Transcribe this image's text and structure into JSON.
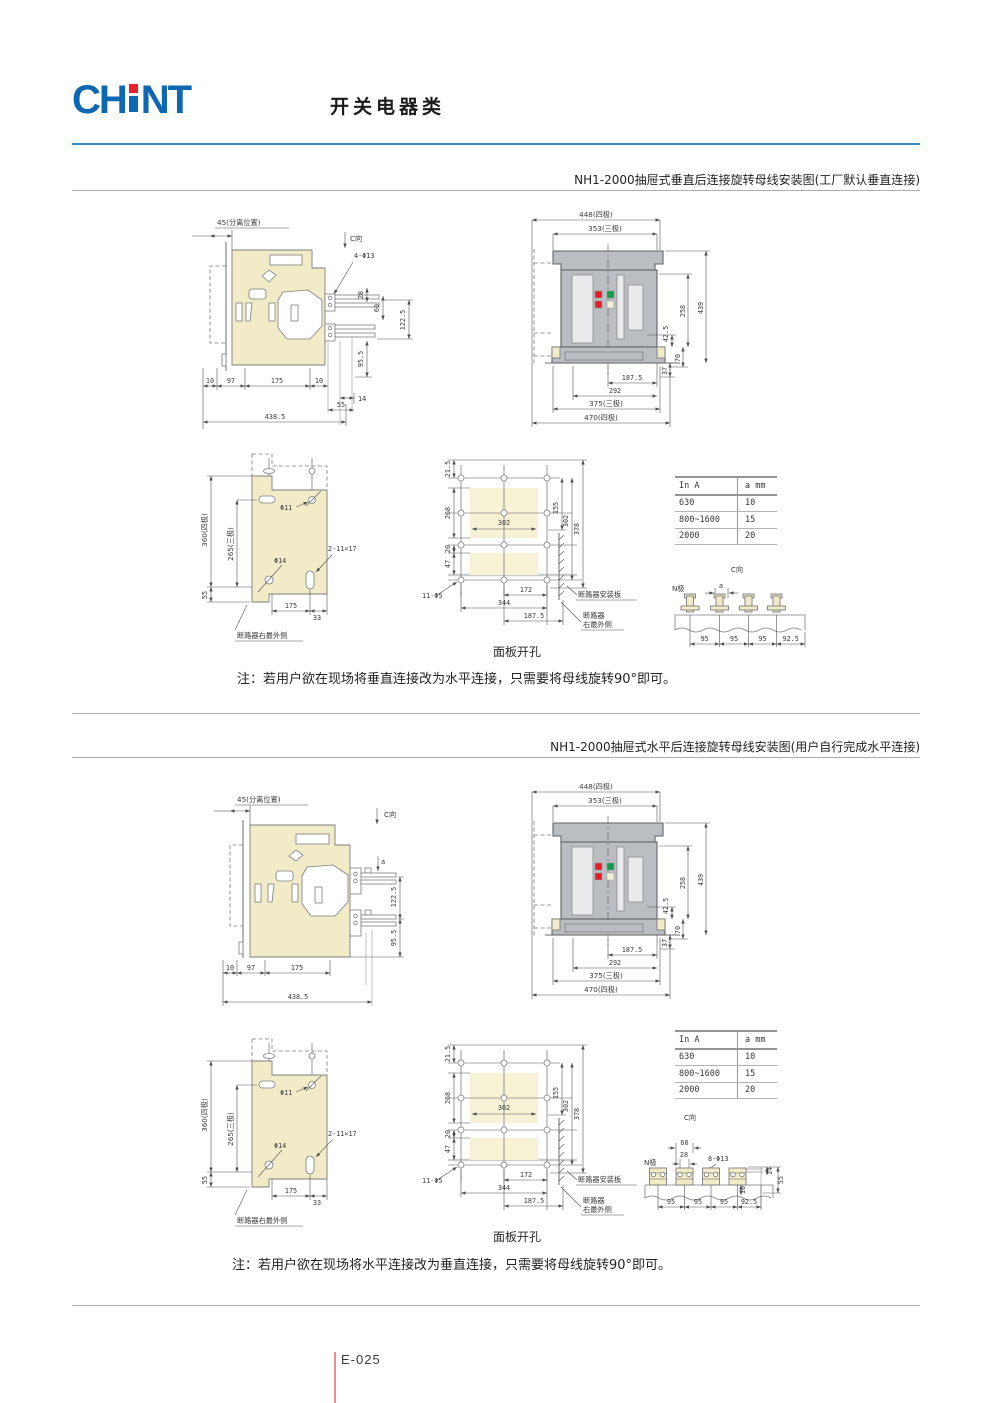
{
  "header": {
    "logo_ch": "CH",
    "logo_nt": "NT",
    "title": "开关电器类"
  },
  "footer": {
    "page_code": "E-025"
  },
  "colors": {
    "brand_blue": "#0d68b1",
    "rule_blue": "#3c86c6",
    "body_cream": "#f2ebc7",
    "housing_gray": "#babdc1",
    "indicator_red": "#e41e26",
    "indicator_green": "#149a48",
    "footer_line_red": "#ec8c8c"
  },
  "ref_table": {
    "col_current": "In A",
    "col_a": "a mm",
    "rows": [
      [
        "630",
        "10"
      ],
      [
        "800~1600",
        "15"
      ],
      [
        "2000",
        "20"
      ]
    ]
  },
  "s1": {
    "title": "NH1-2000抽屉式垂直后连接旋转母线安装图(工厂默认垂直连接)",
    "note": "注：若用户欲在现场将垂直连接改为水平连接，只需要将母线旋转90°即可。",
    "side": {
      "separation": "45(分离位置)",
      "c_dir": "C向",
      "hole": "4-Φ13",
      "d28": "28",
      "d60": "60",
      "d122_5": "122.5",
      "d95_5": "95.5",
      "d10a": "10",
      "d97": "97",
      "d175": "175",
      "d10b": "10",
      "d14": "14",
      "d55": "55",
      "d438_5": "438.5"
    },
    "front": {
      "d448": "448(四极)",
      "d353": "353(三极)",
      "d258": "258",
      "d439": "439",
      "d42_5": "42.5",
      "d70": "70",
      "d37": "37",
      "d187_5": "187.5",
      "d292": "292",
      "d375": "375(三极)",
      "d470": "470(四极)"
    },
    "plate": {
      "d360": "360(四极)",
      "d265": "265(三极)",
      "d55": "55",
      "h11": "Φ11",
      "h14": "Φ14",
      "slot": "2-11×17",
      "d175": "175",
      "d33": "33",
      "outer": "断路器右最外侧"
    },
    "panel": {
      "caption": "面板开孔",
      "d21_5": "21.5",
      "d268": "268",
      "d20": "20",
      "d47": "47",
      "d155": "155",
      "d302r": "302",
      "d378": "378",
      "d302": "302",
      "d172": "172",
      "d344": "344",
      "d187_5": "187.5",
      "holes": "11-Φ5",
      "mount": "断路器安装板",
      "outer1": "断路器",
      "outer2": "右最外侧"
    },
    "bus": {
      "c_dir": "C向",
      "n_pole": "N极",
      "a": "a",
      "d1": "95",
      "d2": "95",
      "d3": "95",
      "d4": "92.5"
    }
  },
  "s2": {
    "title": "NH1-2000抽屉式水平后连接旋转母线安装图(用户自行完成水平连接)",
    "note": "注：若用户欲在现场将水平连接改为垂直连接，只需要将母线旋转90°即可。",
    "side": {
      "separation": "45(分离位置)",
      "c_dir": "C向",
      "a": "a",
      "d122_5": "122.5",
      "d95_5": "95.5",
      "d10": "10",
      "d97": "97",
      "d175": "175",
      "d438_5": "438.5"
    },
    "front": {
      "d448": "448(四极)",
      "d353": "353(三极)",
      "d258": "258",
      "d439": "439",
      "d42_5": "42.5",
      "d70": "70",
      "d37": "37",
      "d187_5": "187.5",
      "d292": "292",
      "d375": "375(三极)",
      "d470": "470(四极)"
    },
    "plate": {
      "d360": "360(四极)",
      "d265": "265(三极)",
      "d55": "55",
      "h11": "Φ11",
      "h14": "Φ14",
      "slot": "2-11×17",
      "d175": "175",
      "d33": "33",
      "outer": "断路器右最外侧"
    },
    "panel": {
      "caption": "面板开孔",
      "d21_5": "21.5",
      "d268": "268",
      "d20": "20",
      "d47": "47",
      "d155": "155",
      "d302r": "302",
      "d378": "378",
      "d302": "302",
      "d172": "172",
      "d344": "344",
      "d187_5": "187.5",
      "holes": "11-Φ5",
      "mount": "断路器安装板",
      "outer1": "断路器",
      "outer2": "右最外侧"
    },
    "bus": {
      "c_dir": "C向",
      "n_pole": "N极",
      "d60": "60",
      "d28": "28",
      "holes": "8-Φ13",
      "d14": "14",
      "d55": "55",
      "d10": "10",
      "d1": "95",
      "d2": "95",
      "d3": "95",
      "d4": "92.5"
    }
  }
}
